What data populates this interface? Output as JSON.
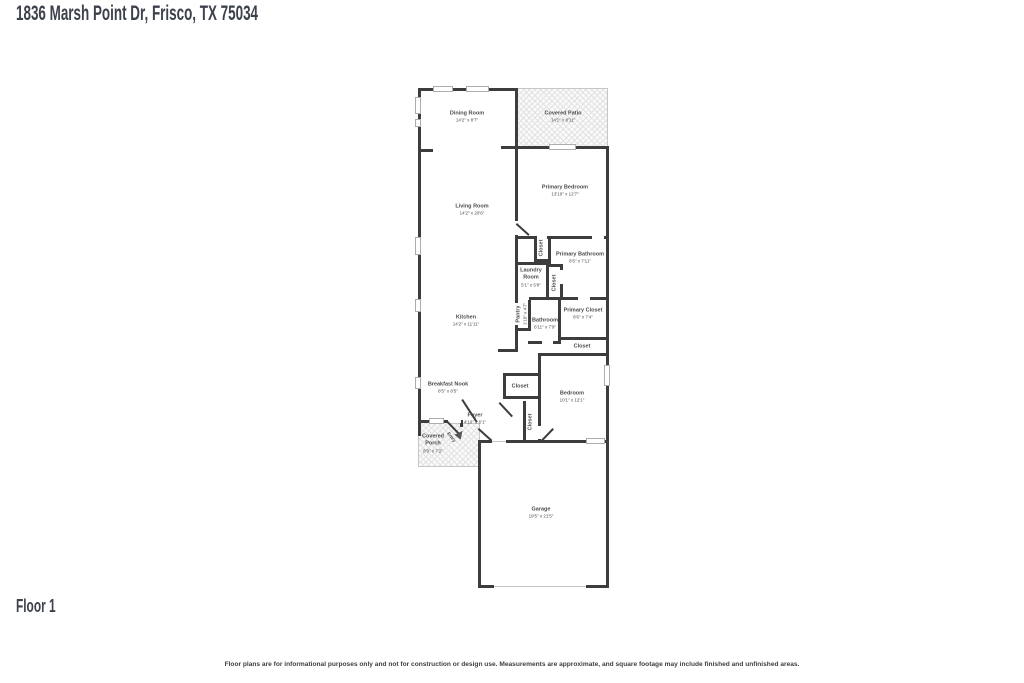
{
  "header": {
    "title": "1836 Marsh Point Dr, Frisco, TX 75034"
  },
  "floor": {
    "label": "Floor 1"
  },
  "footer": {
    "disclaimer": "Floor plans are for informational purposes only and not for construction or design use. Measurements are approximate, and square footage may include finished and unfinished areas."
  },
  "colors": {
    "wall": "#3d3d3d",
    "label_text": "#4b4b4b",
    "title_text": "#3c414b"
  },
  "rooms": {
    "dining": {
      "name": "Dining Room",
      "dims": "14'2\" x 8'7\""
    },
    "covered_patio": {
      "name": "Covered Patio",
      "dims": "14'1\" x 8'11\""
    },
    "primary_bedroom": {
      "name": "Primary Bedroom",
      "dims": "13'10\" x 12'7\""
    },
    "living": {
      "name": "Living Room",
      "dims": "14'2\" x 20'6\""
    },
    "primary_bathroom": {
      "name": "Primary Bathroom",
      "dims": "8'5\" x 7'11\""
    },
    "laundry": {
      "name": "Laundry Room",
      "dims": "5'1\" x 5'8\""
    },
    "closet_bedroom": {
      "name": "Closet"
    },
    "closet_bath": {
      "name": "Closet"
    },
    "kitchen": {
      "name": "Kitchen",
      "dims": "14'2\" x 11'11\""
    },
    "pantry": {
      "name": "Pantry",
      "dims": "1'10\" x 4'7\""
    },
    "bathroom": {
      "name": "Bathroom",
      "dims": "6'11\" x 7'9\""
    },
    "primary_closet": {
      "name": "Primary Closet",
      "dims": "8'6\" x 7'4\""
    },
    "closet_under_primary": {
      "name": "Closet"
    },
    "breakfast_nook": {
      "name": "Breakfast Nook",
      "dims": "8'5\" x 8'5\""
    },
    "closet_hall": {
      "name": "Closet"
    },
    "closet_coat": {
      "name": "Closet"
    },
    "bedroom": {
      "name": "Bedroom",
      "dims": "10'1\" x 12'1\""
    },
    "foyer": {
      "name": "Foyer",
      "dims": "4'10\" x 6'1\""
    },
    "covered_porch": {
      "name": "Covered Porch",
      "dims": "8'9\" x 7'2\""
    },
    "entry": {
      "name": "Entry"
    },
    "garage": {
      "name": "Garage",
      "dims": "19'5\" x 21'5\""
    }
  }
}
